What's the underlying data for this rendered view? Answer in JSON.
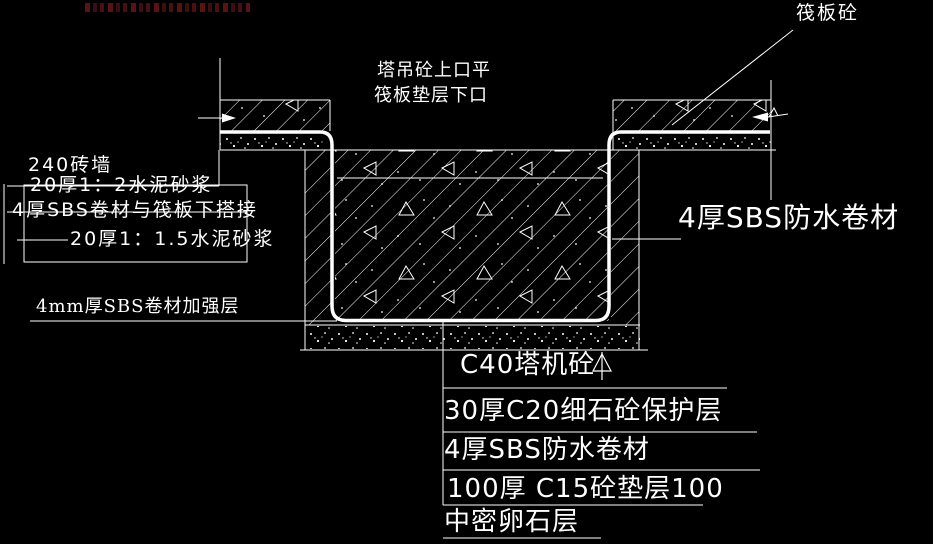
{
  "colors": {
    "background": "#000000",
    "line": "#ffffff",
    "watermark": "#6a1515"
  },
  "labels": {
    "raft_slab": "筏板砼",
    "level_note_line1": "塔吊砼上口平",
    "level_note_line2": "筏板垫层下口",
    "wall_layers": [
      "240砖墙",
      "20厚1：2水泥砂浆",
      "4厚SBS卷材与筏板下搭接",
      "20厚1：1.5水泥砂浆"
    ],
    "reinforcement_note": "4mm厚SBS卷材加强层",
    "membrane_side_note": "4厚SBS防水卷材",
    "bottom_layers": [
      "C40塔机砼",
      "30厚C20细石砼保护层",
      "4厚SBS防水卷材",
      "100厚 C15砼垫层100",
      "中密卵石层"
    ]
  }
}
